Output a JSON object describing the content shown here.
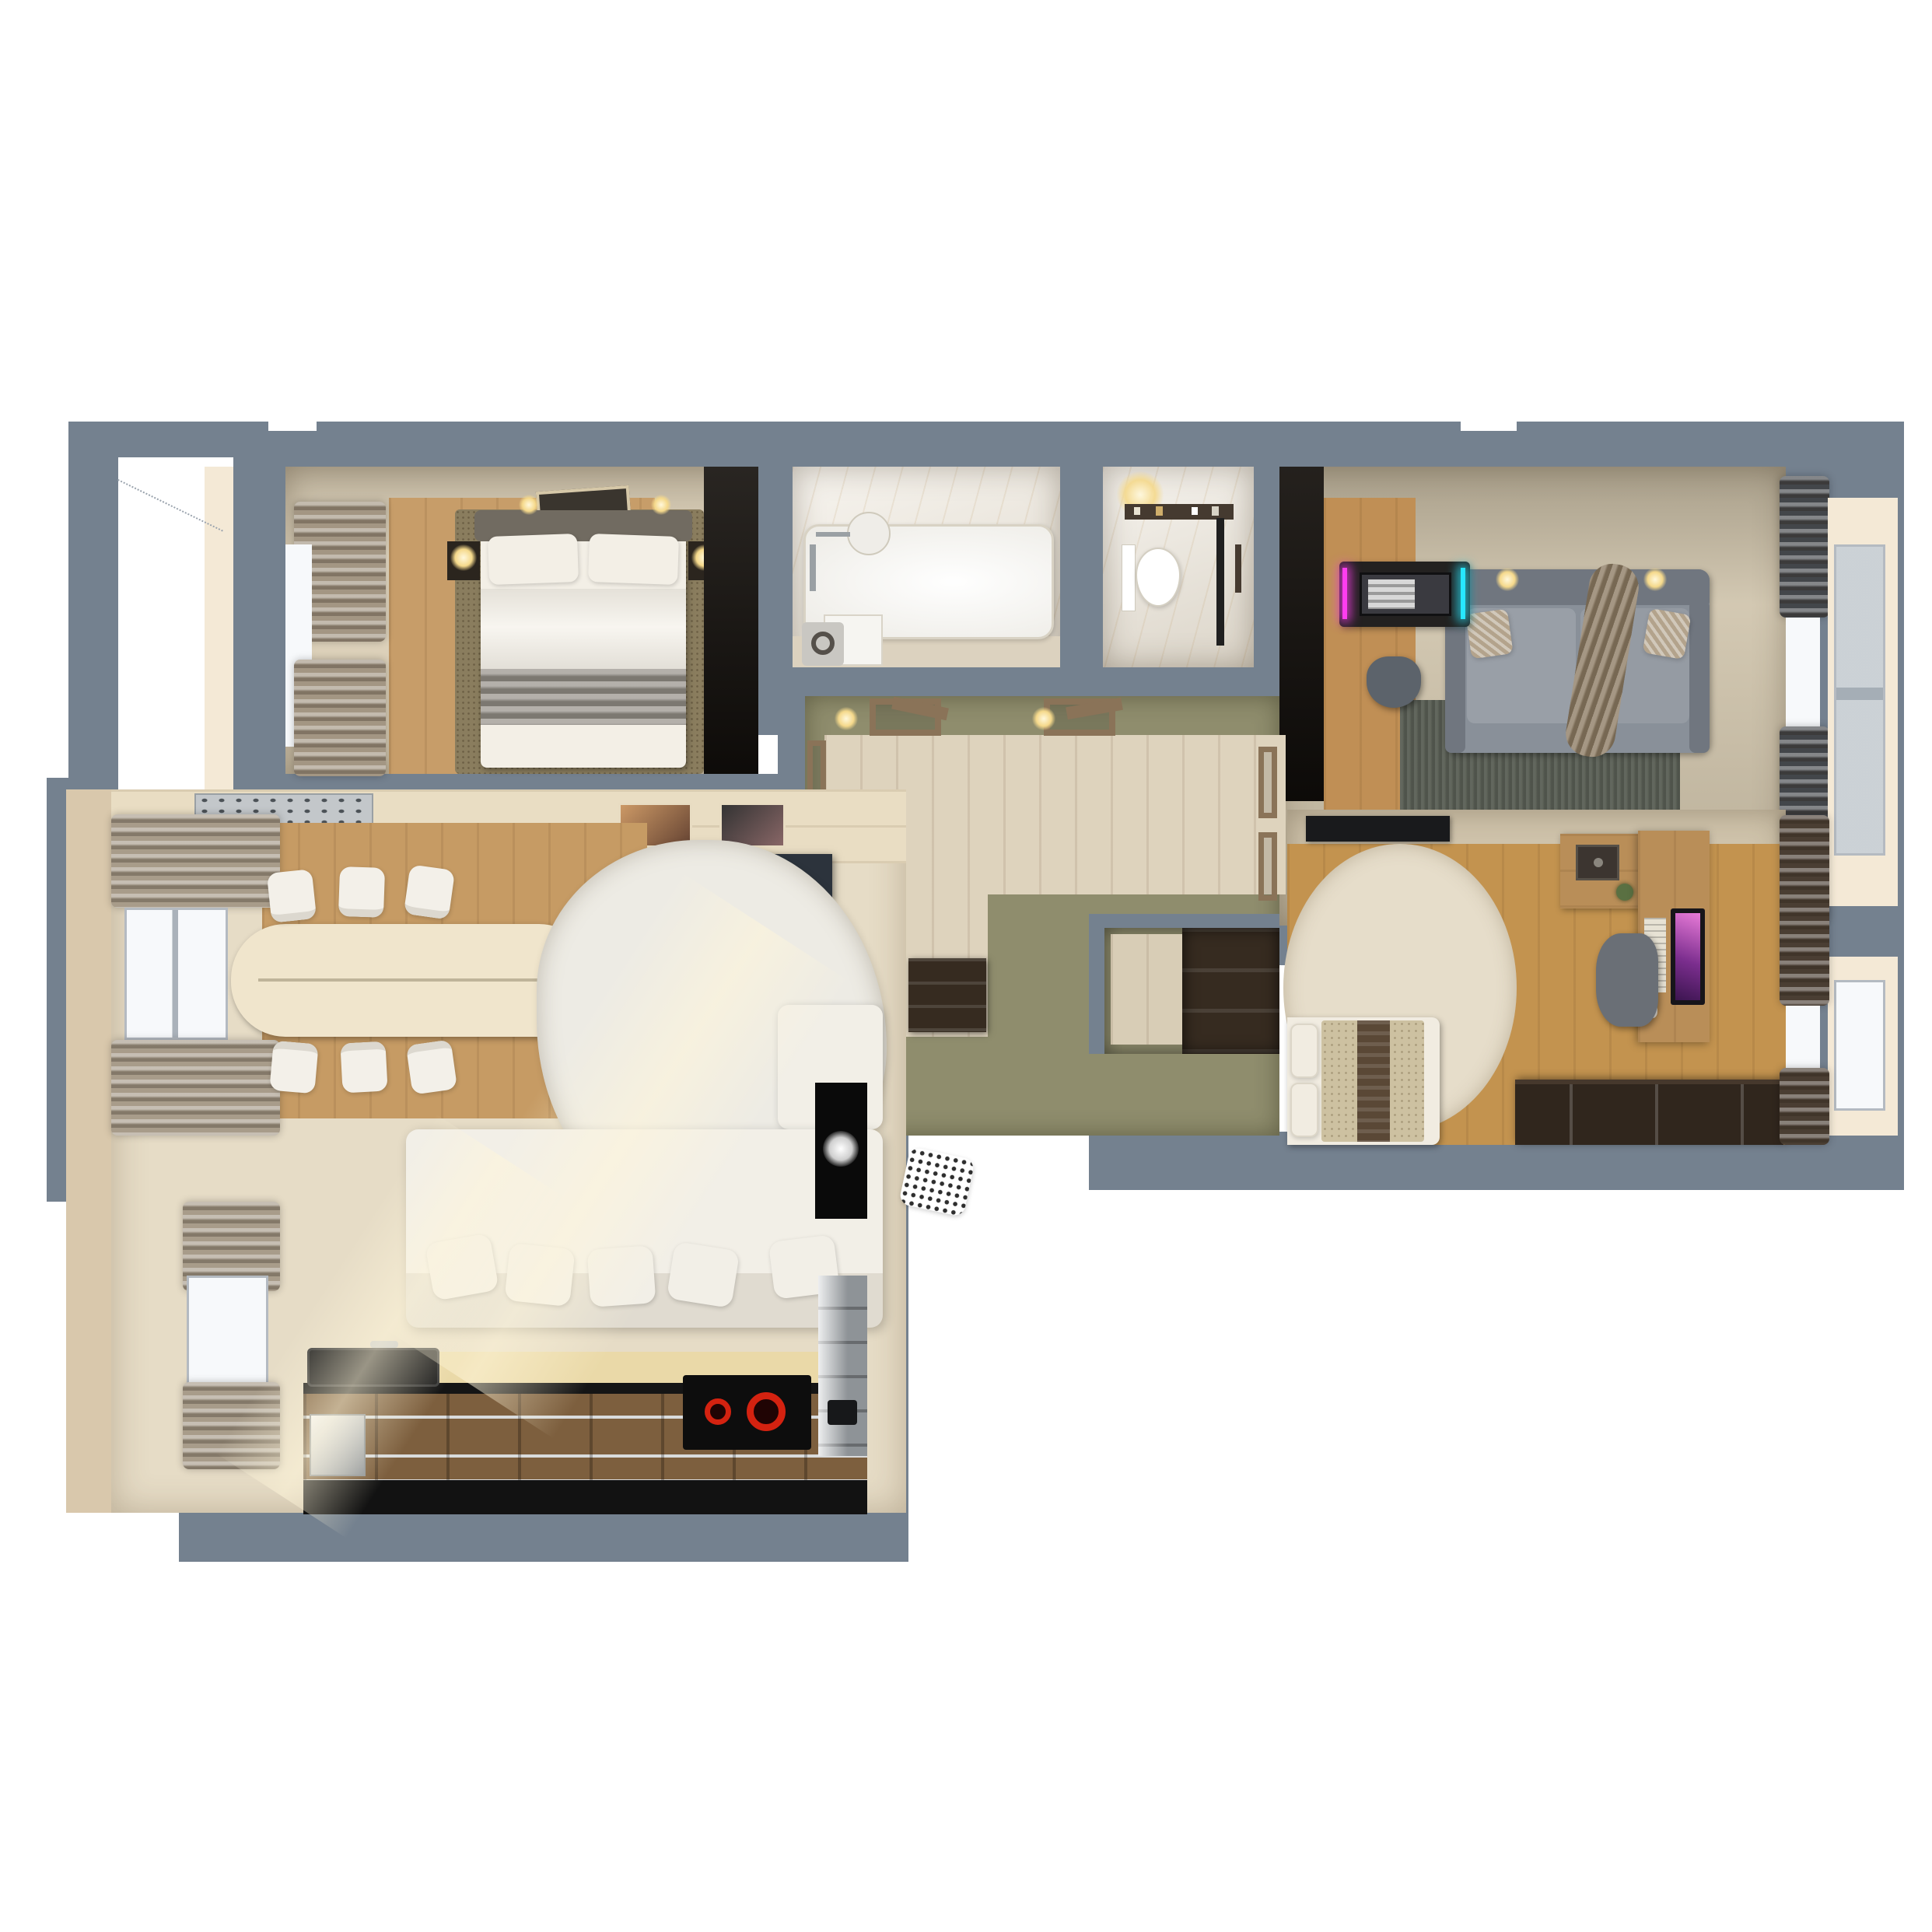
{
  "scene": {
    "kind": "3d-floorplan-top-down-render",
    "description": "Photorealistic top-down 3D render of a two-bedroom apartment floor plan on a white background",
    "background": "#ffffff"
  },
  "colors": {
    "wall": "#74818f",
    "wall_dark": "#6b7887",
    "outside": "#ffffff",
    "balcony_floor": "#f4e9d6",
    "hall_wall": "#8f8d6d",
    "hall_floor": "#ded3bd",
    "door_wood": "#8a7358",
    "window_white": "#f7f9fb",
    "window_frame": "#aab2ba",
    "bedroom1": {
      "ceiling": "#e4d7bd",
      "floor": "#c79d69",
      "rug": "#8a7d5e",
      "linen": "#f3efe6",
      "blanket": "#97928a",
      "headboard": "#716b61",
      "curtain": "#a39683",
      "wardrobe": "#17130f",
      "art": "#3a352e",
      "nightstand": "#2b251e"
    },
    "bathroom": {
      "marble": "#ece5d8",
      "floor": "#dcd2bf",
      "tub": "#fbfbf9",
      "fixture": "#9aa0a4",
      "vanity": "#f6f5f1",
      "washer": "#c9c7c2"
    },
    "wc": {
      "marble": "#e9e2d5",
      "toilet": "#ffffff",
      "shelf": "#453a30",
      "glass": "#202020"
    },
    "lounge": {
      "ceiling": "#cdc1a8",
      "floor": "#c08f55",
      "rug": "#5a5f55",
      "sofa": "#899099",
      "sofa_dark": "#70767f",
      "pillow": "#b3a38c",
      "throw": "#8c7a61",
      "desk": "#232120",
      "rgb_left": "#ff3df0",
      "rgb_right": "#27e7ff",
      "chair": "#5c636b",
      "curtain": "#43464a"
    },
    "bedroom2": {
      "ceiling": "#cfc3ab",
      "floor": "#c3934f",
      "rug": "#e6ddca",
      "linen": "#f1ece1",
      "blanket": "#cdc1a1",
      "blanket_stripe": "#5a4836",
      "desk": "#b98e58",
      "shelf": "#b98e58",
      "safe": "#3c3530",
      "monitor": "#7b2e8e",
      "chest": "#30261d",
      "curtain": "#4a3e33",
      "chair": "#6a6f76",
      "plant": "#5a7042",
      "tv": "#191a1c"
    },
    "living": {
      "floor": "#e6dcc6",
      "wallface": "#d9c8ac",
      "sideboard": "#e9ddc3",
      "dining_wood": "#c69b64",
      "table": "#f0e5cc",
      "chair": "#f3f0e9",
      "rug": "#edebe4",
      "sofa": "#f2efe7",
      "tv": "#17181a",
      "counter_black": "#121212",
      "cabinet": "#7d5f3e",
      "backsplash": "#ead9a8",
      "steel": "#c3c7ca",
      "cooktop": "#0d0d0d",
      "burner": "#d42210",
      "curtain": "#a89c8a",
      "column": "#0a0a0a",
      "sink": "#1f1f1f"
    },
    "closet": {
      "shelf": "#362b20",
      "floor": "#d8cdb6"
    }
  },
  "rooms": [
    {
      "name": "bedroom-1",
      "position": "top-left"
    },
    {
      "name": "bathroom",
      "position": "top-center-left"
    },
    {
      "name": "wc",
      "position": "top-center"
    },
    {
      "name": "lounge-gaming-room",
      "position": "top-right"
    },
    {
      "name": "hallway",
      "position": "center"
    },
    {
      "name": "walk-in-closet",
      "position": "center-right"
    },
    {
      "name": "bedroom-2",
      "position": "middle-right"
    },
    {
      "name": "living-dining-room",
      "position": "left"
    },
    {
      "name": "kitchen",
      "position": "bottom-left"
    },
    {
      "name": "balcony-upper",
      "position": "far-left-top"
    },
    {
      "name": "balcony-lower",
      "position": "far-left-bottom"
    }
  ]
}
